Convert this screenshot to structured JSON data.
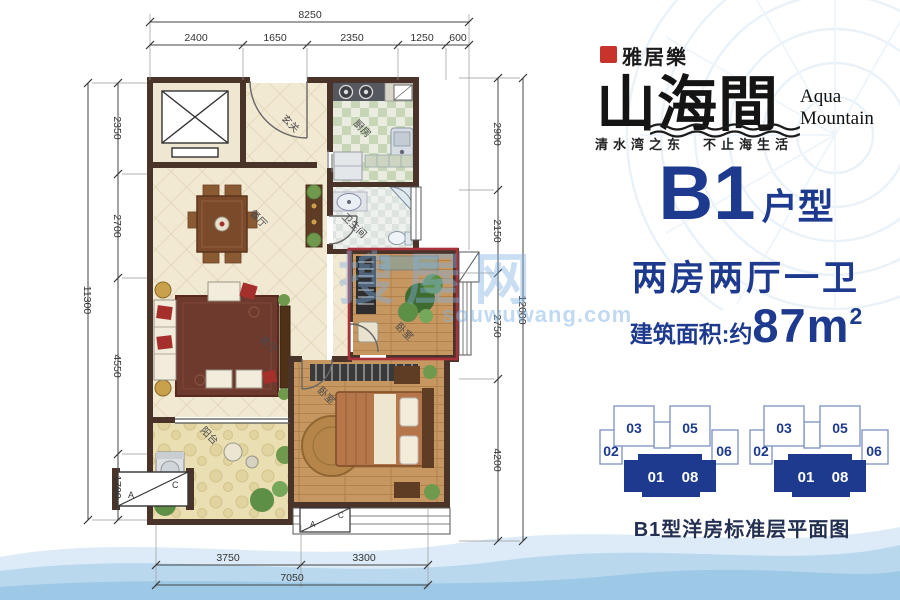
{
  "colors": {
    "navy": "#1e3a8f",
    "seal_red": "#c8342c",
    "plan_highlight_red": "#a8313c",
    "wall_brown": "#4a3429",
    "wave_light": "#dcebf7",
    "wave_mid": "#b9d8ee",
    "wave_deep": "#9dc8e6"
  },
  "logo": {
    "company": "雅居樂",
    "name_cn": "山海間",
    "name_en_line1": "Aqua",
    "name_en_line2": "Mountain",
    "tagline": "清水湾之东　不止海生活"
  },
  "unit_info": {
    "code": "B1",
    "code_suffix": "户型",
    "layout": "两房两厅一卫",
    "area_prefix": "建筑面积:约",
    "area_value": "87m",
    "area_sup": "2"
  },
  "keyplan": {
    "caption": "B1型洋房标准层平面图",
    "unit_labels": {
      "u03": "03",
      "u05": "05",
      "u02": "02",
      "u06": "06",
      "u01": "01",
      "u08": "08"
    }
  },
  "watermark": {
    "cn": "搜屋网",
    "en": "souwuwang.com"
  },
  "plan": {
    "rooms": {
      "entry": "玄关",
      "kitchen": "厨房",
      "bathroom": "卫生间",
      "dining": "餐厅",
      "living": "客厅",
      "balcony": "阳台",
      "bedroom_secondary": "卧室",
      "bedroom_master": "卧室"
    },
    "ac_platform": {
      "a": "A",
      "c": "C"
    },
    "dims": {
      "top": {
        "total": "8250",
        "seg1": "2400",
        "seg2": "1650",
        "seg3": "2350",
        "seg4": "1250",
        "seg5": "600"
      },
      "left": {
        "total": "11300",
        "seg1": "2350",
        "seg2": "2700",
        "seg3": "4550",
        "seg4": "1700"
      },
      "right": {
        "total": "12000",
        "seg1": "2900",
        "seg2": "2150",
        "seg3": "2750",
        "seg4": "4200"
      },
      "bottom": {
        "total": "7050",
        "seg1": "3750",
        "seg2": "3300"
      }
    }
  }
}
